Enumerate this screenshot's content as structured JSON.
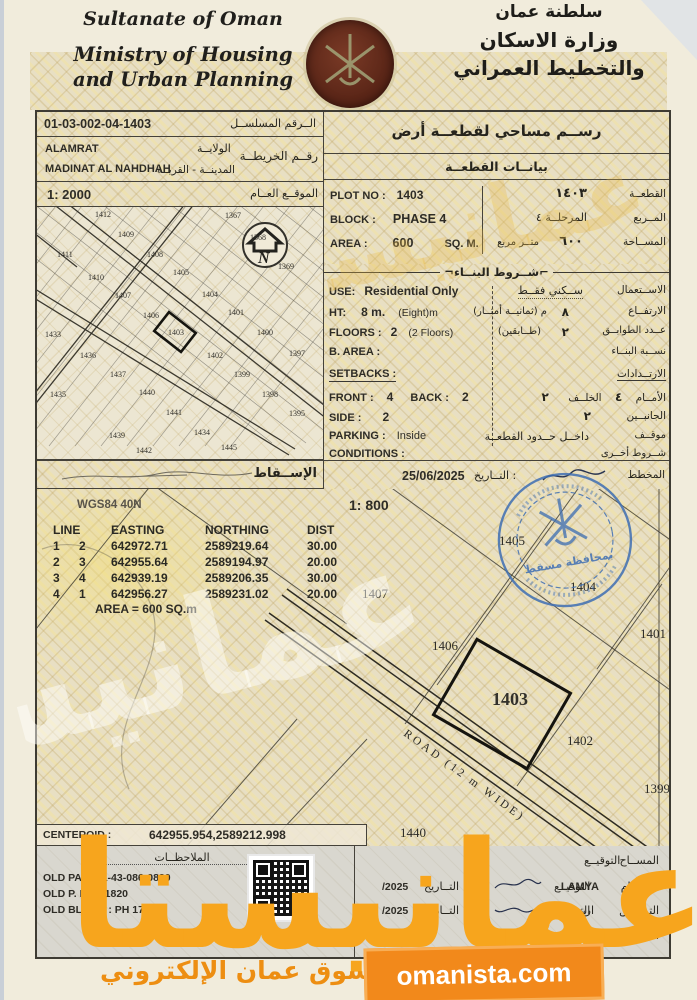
{
  "header": {
    "ministry_en_line1": "Sultanate of Oman",
    "ministry_en_line2": "Ministry of Housing",
    "ministry_en_line3": "and Urban Planning",
    "ministry_ar_line1": "سلطنة عمان",
    "ministry_ar_line2": "وزارة الاسكان",
    "ministry_ar_line3": "والتخطيط العمراني"
  },
  "serial": {
    "label_ar": "الــرقم المسلســل",
    "value": "01-03-002-04-1403"
  },
  "document": {
    "title_ar": "رســم مساحي لقطعــة أرض",
    "section_plot_data_ar": "بيانــات القطعــة",
    "projection_ar": "الإســقاط"
  },
  "location": {
    "wilaya": "ALAMRAT",
    "wilaya_label_ar": "الولايــة",
    "map_no_label_ar": "رقــم الخريطــة",
    "town": "MADINAT AL NAHDHAH",
    "town_label_ar": "المدينــة - القريــة",
    "site_plan_scale": "1: 2000",
    "site_plan_label_ar": "الموقــع العــام"
  },
  "plot": {
    "plot_no_label": "PLOT NO :",
    "plot_no": "1403",
    "plot_no_ar": "١٤٠٣",
    "plot_no_label_ar": "القطعــة",
    "block_label": "BLOCK :",
    "block": "PHASE 4",
    "block_ar": "المرحلــة ٤",
    "block_label_ar": "المــربع",
    "area_label": "AREA :",
    "area": "600",
    "area_unit": "SQ. M.",
    "area_ar": "٦٠٠",
    "area_unit_ar": "متــر مربع",
    "area_label_ar": "المســاحة"
  },
  "conditions": {
    "header_ar": "شــروط البنــاء",
    "use_label": "USE:",
    "use": "Residential Only",
    "use_ar": "ســكني فقــط",
    "use_label_ar": "الاســتعمال",
    "ht_label": "HT:",
    "ht": "8 m.",
    "ht_note": "(Eight)m",
    "ht_value_ar": "٨",
    "ht_note_ar": "م  (ثمانيــة أمتــار)",
    "ht_label_ar": "الارتفــاع",
    "floors_label": "FLOORS :",
    "floors": "2",
    "floors_note": "(2 Floors)",
    "floors_value_ar": "٢",
    "floors_note_ar": "(طــابقين)",
    "floors_label_ar": "عــدد الطوابــق",
    "barea_label": "B. AREA :",
    "barea_label_ar": "نســبة البنــاء",
    "setbacks_label": "SETBACKS :",
    "setbacks_label_ar": "الارتــدادات",
    "front_label": "FRONT :",
    "front": "4",
    "front_ar": "٤",
    "front_label_ar": "الأمــام",
    "back_label": "BACK :",
    "back": "2",
    "back_ar": "٢",
    "back_label_ar": "الخلــف",
    "side_label": "SIDE :",
    "side": "2",
    "side_ar": "٢",
    "side_label_ar": "الجانبــين",
    "parking_label": "PARKING :",
    "parking": "Inside",
    "parking_ar": "داخــل حــدود القطعــة",
    "parking_label_ar": "موقــف",
    "conditions_label": "CONDITIONS :",
    "conditions_label_ar": "شــروط أخــرى"
  },
  "approval": {
    "date": "25/06/2025",
    "date_label_ar": "التــاريخ",
    "planner_label_ar": "المخطط"
  },
  "survey": {
    "datum": "WGS84 40N",
    "scale": "1: 800",
    "table_headers": [
      "LINE",
      "EASTING",
      "NORTHING",
      "DIST"
    ],
    "table_rows": [
      [
        "1",
        "2",
        "642972.71",
        "2589219.64",
        "30.00"
      ],
      [
        "2",
        "3",
        "642955.64",
        "2589194.97",
        "20.00"
      ],
      [
        "3",
        "4",
        "642939.19",
        "2589206.35",
        "30.00"
      ],
      [
        "4",
        "1",
        "642956.27",
        "2589231.02",
        "20.00"
      ]
    ],
    "area_note": "AREA = 600  SQ.m",
    "centeroid_label": "CENTEROID :",
    "centeroid_value": "642955.954,2589212.998",
    "road_label": "ROAD (12 m WIDE)"
  },
  "map2000": {
    "highlight_plot": "1403",
    "plots": [
      {
        "label": "1412",
        "x": 58,
        "y": 10
      },
      {
        "label": "1367",
        "x": 188,
        "y": 11
      },
      {
        "label": "1409",
        "x": 81,
        "y": 30
      },
      {
        "label": "1368",
        "x": 213,
        "y": 33
      },
      {
        "label": "1411",
        "x": 20,
        "y": 50
      },
      {
        "label": "1408",
        "x": 110,
        "y": 50
      },
      {
        "label": "1369",
        "x": 241,
        "y": 62
      },
      {
        "label": "1410",
        "x": 51,
        "y": 73
      },
      {
        "label": "1405",
        "x": 136,
        "y": 68
      },
      {
        "label": "1404",
        "x": 165,
        "y": 90
      },
      {
        "label": "1407",
        "x": 78,
        "y": 91
      },
      {
        "label": "1401",
        "x": 191,
        "y": 108
      },
      {
        "label": "1406",
        "x": 106,
        "y": 111
      },
      {
        "label": "1400",
        "x": 220,
        "y": 128
      },
      {
        "label": "1433",
        "x": 8,
        "y": 130
      },
      {
        "label": "1436",
        "x": 43,
        "y": 151
      },
      {
        "label": "1403",
        "x": 131,
        "y": 128
      },
      {
        "label": "1402",
        "x": 170,
        "y": 151
      },
      {
        "label": "1397",
        "x": 252,
        "y": 149
      },
      {
        "label": "1437",
        "x": 73,
        "y": 170
      },
      {
        "label": "1399",
        "x": 197,
        "y": 170
      },
      {
        "label": "1435",
        "x": 13,
        "y": 190
      },
      {
        "label": "1440",
        "x": 102,
        "y": 188
      },
      {
        "label": "1398",
        "x": 225,
        "y": 190
      },
      {
        "label": "1441",
        "x": 129,
        "y": 208
      },
      {
        "label": "1395",
        "x": 252,
        "y": 209
      },
      {
        "label": "1439",
        "x": 72,
        "y": 231
      },
      {
        "label": "1434",
        "x": 157,
        "y": 228
      },
      {
        "label": "1442",
        "x": 99,
        "y": 246
      },
      {
        "label": "1445",
        "x": 184,
        "y": 243
      }
    ]
  },
  "map800": {
    "highlight_plot": "1403",
    "plots": [
      {
        "label": "1405",
        "x": 462,
        "y": 56
      },
      {
        "label": "1404",
        "x": 533,
        "y": 102
      },
      {
        "label": "1407",
        "x": 325,
        "y": 109
      },
      {
        "label": "1401",
        "x": 603,
        "y": 149
      },
      {
        "label": "1406",
        "x": 395,
        "y": 161
      },
      {
        "label": "1403",
        "x": 455,
        "y": 216,
        "big": true
      },
      {
        "label": "1402",
        "x": 530,
        "y": 256
      },
      {
        "label": "1399",
        "x": 607,
        "y": 304
      },
      {
        "label": "1440",
        "x": 363,
        "y": 348
      }
    ]
  },
  "remarks": {
    "header_ar": "الملاحظــات",
    "old_pain": "OLD PAIN : 1-43-086-0820",
    "old_p_no": "OLD P. NO : 1820",
    "old_block": "OLD BLOCK : PH 17"
  },
  "signatures": {
    "sign_label_ar": "التوقيــع",
    "date_label_ar": "التــاريخ",
    "rows": [
      {
        "role_ar": "المســاح",
        "name": "",
        "date": ""
      },
      {
        "role_ar": "الرســام",
        "name": "LAMYA",
        "date": "/2025"
      },
      {
        "role_ar": "التــدقيق",
        "name": "اريج",
        "date": "/2025"
      },
      {
        "role_ar": "المســند",
        "name": "…RA AL RAWAHI",
        "date": ""
      }
    ]
  },
  "stamps": {
    "blue_stamp_ar": "بمحافظة مسقط"
  },
  "watermark": {
    "brand_ar": "عمانيستا",
    "site": "omanista.com",
    "tagline_ar": "سوق عمان الإلكتروني"
  }
}
